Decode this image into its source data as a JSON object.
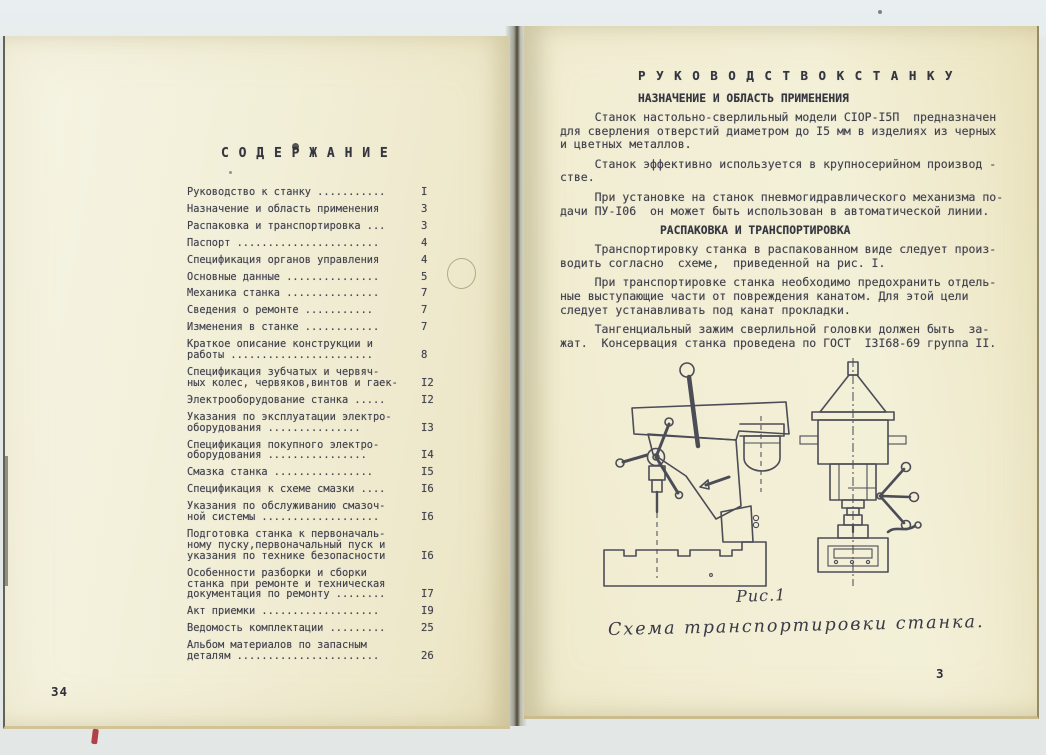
{
  "left_page": {
    "page_number": "34",
    "toc": {
      "title": "С О Д Е Р Ж А Н И Е",
      "entries": [
        {
          "label": "Руководство к станку ...........",
          "page": "I"
        },
        {
          "label": "Назначение и область применения",
          "page": "3"
        },
        {
          "label": "Распаковка и транспортировка ...",
          "page": "3"
        },
        {
          "label": "Паспорт .......................",
          "page": "4"
        },
        {
          "label": "Спецификация органов управления",
          "page": "4"
        },
        {
          "label": "Основные данные ...............",
          "page": "5"
        },
        {
          "label": "Механика станка ...............",
          "page": "7"
        },
        {
          "label": "Сведения о ремонте ...........",
          "page": "7"
        },
        {
          "label": "Изменения в станке ............",
          "page": "7"
        },
        {
          "label": "Краткое описание конструкции и\nработы .......................",
          "page": "8"
        },
        {
          "label": "Спецификация зубчатых и червяч-\nных колес, червяков,винтов и гаек-",
          "page": "I2"
        },
        {
          "label": "Электрооборудование станка .....",
          "page": "I2"
        },
        {
          "label": "Указания по эксплуатации электро-\nоборудования ...............",
          "page": "I3"
        },
        {
          "label": "Спецификация покупного электро-\nоборудования ................",
          "page": "I4"
        },
        {
          "label": "Смазка станка ................",
          "page": "I5"
        },
        {
          "label": "Спецификация к схеме смазки ....",
          "page": "I6"
        },
        {
          "label": "Указания по обслуживанию смазоч-\nной системы ...................",
          "page": "I6"
        },
        {
          "label": "Подготовка станка к первоначаль-\nному пуску,первоначальный пуск и\nуказания по технике безопасности",
          "page": "I6"
        },
        {
          "label": "Особенности разборки и сборки\nстанка при ремонте и техническая\nдокументация по ремонту ........",
          "page": "I7"
        },
        {
          "label": "Акт приемки ...................",
          "page": "I9"
        },
        {
          "label": "Ведомость комплектации .........",
          "page": "25"
        },
        {
          "label": "Альбом материалов по запасным\nдеталям .......................",
          "page": "26"
        }
      ]
    }
  },
  "right_page": {
    "page_number": "3",
    "title": "Р У К О В О Д С Т В О   К   С Т А Н К У",
    "section1_heading": "НАЗНАЧЕНИЕ И ОБЛАСТЬ ПРИМЕНЕНИЯ",
    "para1": "     Станок настольно-сверлильный модели СIOР-I5П  предназначен\nдля сверления отверстий диаметром до I5 мм в изделиях из черных\nи цветных металлов.",
    "para2": "     Станок эффективно используется в крупносерийном производ -\nстве.",
    "para3": "     При установке на станок пневмогидравлического механизма по-\nдачи ПУ-I06  он может быть использован в автоматической линии.",
    "section2_heading": "РАСПАКОВКА  И  ТРАНСПОРТИРОВКА",
    "para4": "     Транспортировку станка в распакованном виде следует произ-\nводить согласно  схеме,  приведенной на рис. I.",
    "para5": "     При транспортировке станка необходимо предохранить отдель-\nные выступающие части от повреждения канатом. Для этой цели\nследует устанавливать под канат прокладки.",
    "para6": "     Тангенциальный зажим сверлильной головки должен быть  за-\nжат.  Консервация станка проведена по ГОСТ  I3I68-69 группа II.",
    "figure": {
      "caption": "Рис.1",
      "subcaption": "Схема  транспортировки  станка."
    }
  }
}
